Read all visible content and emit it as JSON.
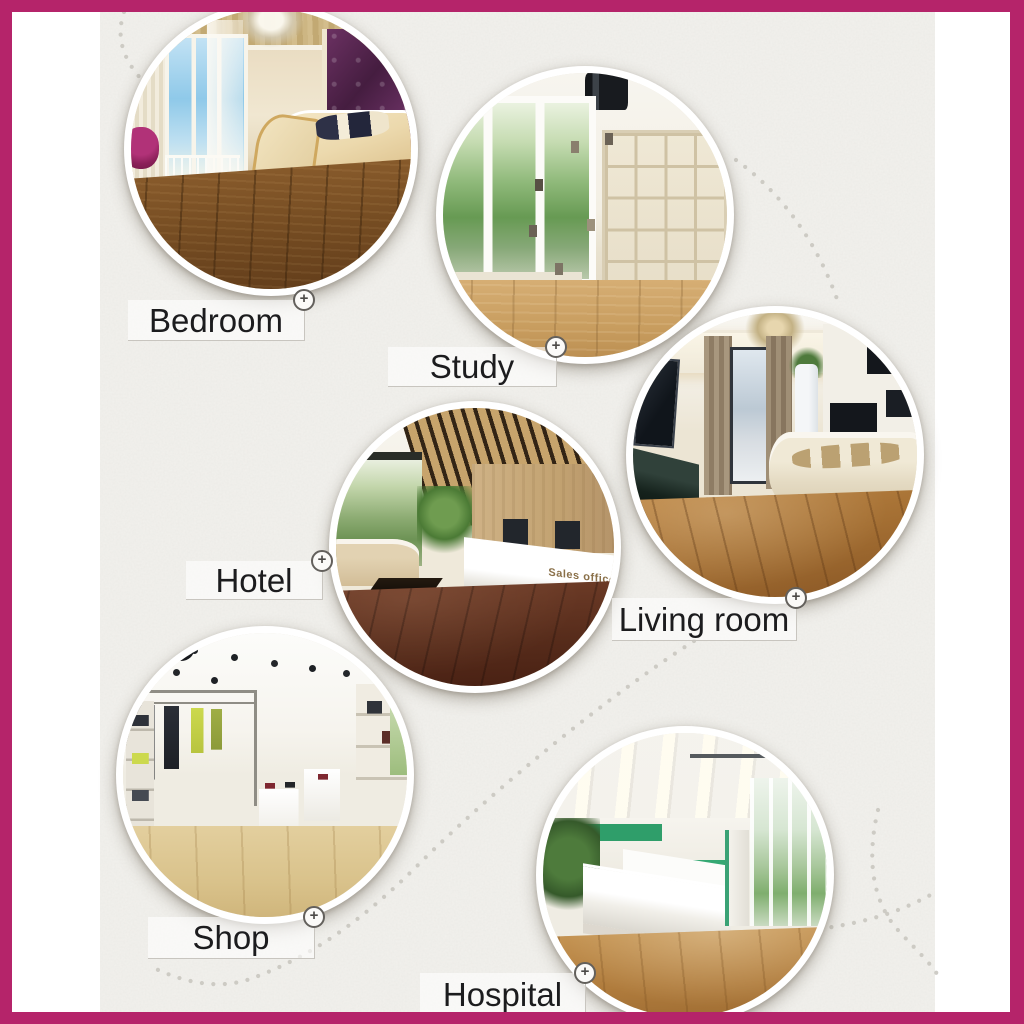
{
  "frame": {
    "border_color": "#b5246a"
  },
  "panel": {
    "background": "#f2f1ed",
    "margin_background": "#ffffff"
  },
  "decor": {
    "dot_trail_color": "#c9c6c0",
    "label_line_color": "#c8c5bf",
    "label_text_color": "#1c1c1e",
    "label_background": "rgba(255,255,255,0.6)"
  },
  "icons": {
    "plus_circle": "+"
  },
  "rooms": [
    {
      "id": "bedroom",
      "label": "Bedroom"
    },
    {
      "id": "study",
      "label": "Study"
    },
    {
      "id": "hotel",
      "label": "Hotel"
    },
    {
      "id": "living-room",
      "label": "Living room"
    },
    {
      "id": "shop",
      "label": "Shop"
    },
    {
      "id": "hospital",
      "label": "Hospital"
    }
  ],
  "scene_texts": {
    "hotel_desk_sign": "Sales office"
  }
}
